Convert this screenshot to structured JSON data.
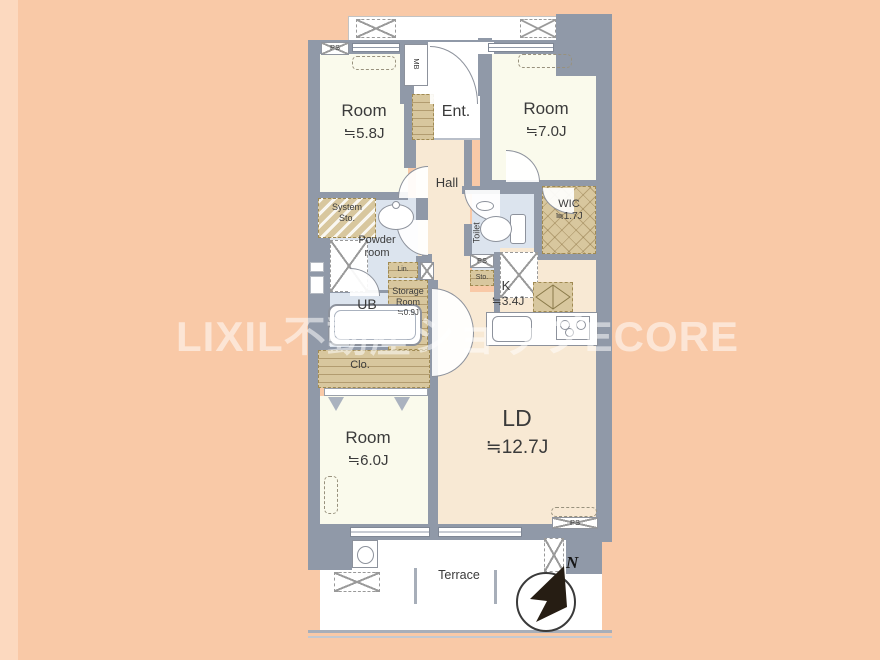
{
  "colors": {
    "background": "#f9c9a7",
    "wall": "#9099a8",
    "room_cream": "#fafaec",
    "living_peach": "#f8e9d4",
    "wet_area_blue": "#dce4ee",
    "closet_tan": "#d8c79e",
    "watermark": "#ffffff"
  },
  "watermark": {
    "text": "LIXIL不動産ショップECORE"
  },
  "rooms": {
    "room_nw": {
      "name": "Room",
      "size": "≒5.8J"
    },
    "entrance": {
      "name": "Ent."
    },
    "room_ne": {
      "name": "Room",
      "size": "≒7.0J"
    },
    "hall": {
      "name": "Hall"
    },
    "system_storage": {
      "line1": "System",
      "line2": "Sto."
    },
    "powder_room": {
      "line1": "Powder",
      "line2": "room"
    },
    "toilet": {
      "name": "Toilet"
    },
    "wic": {
      "name": "WIC",
      "size": "≒1.7J"
    },
    "unit_bath": {
      "name": "UB"
    },
    "storage_room": {
      "line1": "Storage",
      "line2": "Room",
      "size": "≒0.9J"
    },
    "kitchen": {
      "name": "K",
      "size": "≒3.4J"
    },
    "closet": {
      "name": "Clo."
    },
    "room_sw": {
      "name": "Room",
      "size": "≒6.0J"
    },
    "living_dining": {
      "name": "LD",
      "size": "≒12.7J"
    },
    "terrace": {
      "name": "Terrace"
    }
  },
  "shafts": {
    "ps_top_left": "PS",
    "meter_box": "MB",
    "linen": "Lin.",
    "ps_center": "PS",
    "storage_small": "Sto.",
    "ps_bottom_right": "PS"
  },
  "compass": {
    "north_label": "N"
  }
}
